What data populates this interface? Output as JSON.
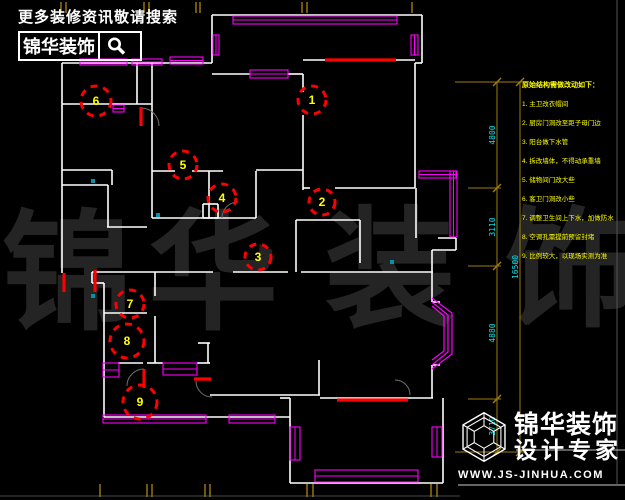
{
  "promo": {
    "tagline": "更多装修资讯敬请搜索",
    "brand": "锦华装饰",
    "search_icon": "magnifier"
  },
  "watermark": {
    "chars": [
      "锦",
      "华",
      "装",
      "饰"
    ],
    "positions": [
      [
        2,
        318
      ],
      [
        148,
        318
      ],
      [
        325,
        315
      ],
      [
        505,
        315
      ]
    ],
    "font_size": 130,
    "color": "#242424"
  },
  "notes": {
    "title": "原始结构需做改动如下：",
    "items": [
      "1. 主卫改衣帽间",
      "2. 厨房门洞改至距子母门边",
      "3. 阳台做下水管",
      "4. 拆改墙体，不得动承重墙",
      "5. 储物间门改大些",
      "6. 客卫门洞改小些",
      "7. 调整卫生间上下水，加做防水",
      "8. 空调孔需提前预留封堵",
      "9. 比例较大，以现场实测为准"
    ],
    "color": "#ffff00"
  },
  "logo": {
    "brand_line1": "锦华装饰",
    "brand_line2": "设计专家",
    "url": "WWW.JS-JINHUA.COM",
    "glyph": "wireframe-cube-hexagon"
  },
  "dimensions": {
    "line_color": "#a07d0e",
    "text_color": "#00e5ee",
    "inner_x": 497,
    "outer_x": 520,
    "top_y": 82,
    "bottom_y": 452,
    "boundaries": [
      82,
      188,
      266,
      399,
      452
    ],
    "ext_lines": [
      [
        455,
        82,
        524,
        82
      ],
      [
        468,
        188,
        501,
        188
      ],
      [
        468,
        266,
        501,
        266
      ],
      [
        468,
        399,
        501,
        399
      ],
      [
        455,
        452,
        524,
        452
      ]
    ],
    "labels": [
      {
        "t": "4800",
        "x": 495,
        "y": 135
      },
      {
        "t": "3110",
        "x": 495,
        "y": 227
      },
      {
        "t": "4880",
        "x": 495,
        "y": 333
      },
      {
        "t": "3710",
        "x": 495,
        "y": 426
      }
    ],
    "total": {
      "t": "16500",
      "x": 518,
      "y": 267
    },
    "ticks_top_x": [
      61,
      66,
      144,
      149,
      196,
      200,
      302,
      307,
      412
    ],
    "ticks_bottom_x": [
      100,
      147,
      152,
      205,
      210,
      307,
      313,
      431,
      437
    ]
  },
  "plan": {
    "wall_color": "#ffffff",
    "window_color": "#ff00ff",
    "revision_color": "#ff0000",
    "number_color": "#ffff00",
    "walls": [
      [
        62,
        63,
        212,
        63
      ],
      [
        62,
        63,
        62,
        273
      ],
      [
        137,
        63,
        137,
        104
      ],
      [
        62,
        104,
        152,
        104
      ],
      [
        152,
        63,
        152,
        218
      ],
      [
        62,
        170,
        112,
        170
      ],
      [
        112,
        170,
        112,
        185
      ],
      [
        62,
        185,
        108,
        185
      ],
      [
        108,
        185,
        108,
        227
      ],
      [
        107,
        227,
        147,
        227
      ],
      [
        152,
        171,
        175,
        171
      ],
      [
        192,
        171,
        223,
        171
      ],
      [
        209,
        171,
        209,
        218
      ],
      [
        256,
        171,
        256,
        218
      ],
      [
        152,
        218,
        256,
        218
      ],
      [
        256,
        170,
        303,
        170
      ],
      [
        303,
        74,
        303,
        92
      ],
      [
        303,
        115,
        303,
        190
      ],
      [
        212,
        74,
        250,
        74
      ],
      [
        288,
        74,
        303,
        74
      ],
      [
        212,
        15,
        212,
        63
      ],
      [
        212,
        15,
        422,
        15
      ],
      [
        422,
        15,
        422,
        63
      ],
      [
        415,
        63,
        422,
        63
      ],
      [
        303,
        60,
        415,
        60
      ],
      [
        415,
        63,
        415,
        188
      ],
      [
        303,
        188,
        310,
        188
      ],
      [
        335,
        188,
        415,
        188
      ],
      [
        416,
        188,
        416,
        238
      ],
      [
        438,
        238,
        456,
        238
      ],
      [
        296,
        220,
        296,
        272
      ],
      [
        296,
        220,
        360,
        220
      ],
      [
        360,
        220,
        360,
        263
      ],
      [
        456,
        238,
        456,
        250
      ],
      [
        432,
        250,
        456,
        250
      ],
      [
        432,
        250,
        432,
        302
      ],
      [
        432,
        302,
        440,
        302
      ],
      [
        432,
        365,
        440,
        365
      ],
      [
        432,
        365,
        432,
        398
      ],
      [
        320,
        398,
        433,
        398
      ],
      [
        92,
        272,
        213,
        272
      ],
      [
        233,
        272,
        288,
        272
      ],
      [
        301,
        272,
        433,
        272
      ],
      [
        92,
        272,
        92,
        283
      ],
      [
        92,
        283,
        104,
        283
      ],
      [
        104,
        283,
        104,
        417
      ],
      [
        104,
        417,
        290,
        417
      ],
      [
        155,
        272,
        155,
        296
      ],
      [
        155,
        316,
        155,
        363
      ],
      [
        104,
        313,
        147,
        313
      ],
      [
        118,
        363,
        143,
        363
      ],
      [
        147,
        363,
        163,
        363
      ],
      [
        197,
        363,
        210,
        363
      ],
      [
        198,
        343,
        210,
        343
      ],
      [
        208,
        343,
        208,
        363
      ],
      [
        210,
        395,
        320,
        395
      ],
      [
        319,
        360,
        319,
        395
      ],
      [
        290,
        398,
        290,
        483
      ],
      [
        290,
        483,
        443,
        483
      ],
      [
        443,
        398,
        443,
        483
      ],
      [
        280,
        398,
        290,
        398
      ],
      [
        203,
        204,
        218,
        204
      ],
      [
        218,
        204,
        218,
        218
      ],
      [
        203,
        218,
        218,
        218
      ],
      [
        203,
        204,
        203,
        218
      ]
    ],
    "windows": [
      [
        80,
        59,
        47,
        6
      ],
      [
        132,
        59,
        30,
        6
      ],
      [
        170,
        57,
        33,
        7
      ],
      [
        233,
        16,
        164,
        8
      ],
      [
        213,
        35,
        6,
        20
      ],
      [
        411,
        35,
        7,
        20
      ],
      [
        250,
        70,
        38,
        8
      ],
      [
        419,
        171,
        37,
        7
      ],
      [
        450,
        171,
        7,
        66
      ],
      [
        103,
        415,
        103,
        8
      ],
      [
        229,
        415,
        46,
        8
      ],
      [
        103,
        363,
        16,
        14
      ],
      [
        163,
        363,
        34,
        12
      ],
      [
        290,
        427,
        10,
        33
      ],
      [
        432,
        427,
        10,
        30
      ],
      [
        315,
        470,
        103,
        12
      ],
      [
        113,
        105,
        11,
        7
      ]
    ],
    "bay_window_polylines": [
      "432,302 448,315 448,352 432,365",
      "432,298 452,313 452,354 432,369",
      "432,306 444,316 444,351 432,360"
    ],
    "red_marks": [
      [
        141,
        107,
        141,
        126
      ],
      [
        325,
        60,
        396,
        60
      ],
      [
        337,
        400,
        408,
        400
      ],
      [
        144,
        369,
        144,
        388
      ],
      [
        194,
        379,
        211,
        379
      ],
      [
        64,
        273,
        64,
        292
      ],
      [
        95,
        270,
        95,
        292
      ]
    ],
    "door_arcs": [
      "M141 108 A18 18 0 0 1 159 126",
      "M222 218 A16 16 0 0 1 238 202",
      "M144 369 A17 17 0 0 0 127 386",
      "M196 381 A16 16 0 0 0 212 397",
      "M395 380 A15 15 0 0 1 410 395"
    ],
    "cyan_dots": [
      [
        93,
        181
      ],
      [
        158,
        215
      ],
      [
        392,
        262
      ],
      [
        93,
        296
      ]
    ],
    "revision_circles": [
      {
        "n": "1",
        "x": 312,
        "y": 100,
        "r": 14
      },
      {
        "n": "2",
        "x": 322,
        "y": 202,
        "r": 13
      },
      {
        "n": "3",
        "x": 258,
        "y": 257,
        "r": 13
      },
      {
        "n": "4",
        "x": 222,
        "y": 198,
        "r": 14
      },
      {
        "n": "5",
        "x": 183,
        "y": 165,
        "r": 14
      },
      {
        "n": "6",
        "x": 96,
        "y": 101,
        "r": 15
      },
      {
        "n": "7",
        "x": 130,
        "y": 304,
        "r": 14
      },
      {
        "n": "8",
        "x": 127,
        "y": 341,
        "r": 17
      },
      {
        "n": "9",
        "x": 140,
        "y": 402,
        "r": 17
      }
    ],
    "frame_lines": [
      [
        0,
        496,
        460,
        496,
        "#4a4a4a"
      ],
      [
        458,
        485,
        625,
        485,
        "#cccccc"
      ],
      [
        617,
        0,
        617,
        485,
        "#555555"
      ],
      [
        516,
        450,
        625,
        450,
        "#bbbbbb"
      ]
    ]
  }
}
